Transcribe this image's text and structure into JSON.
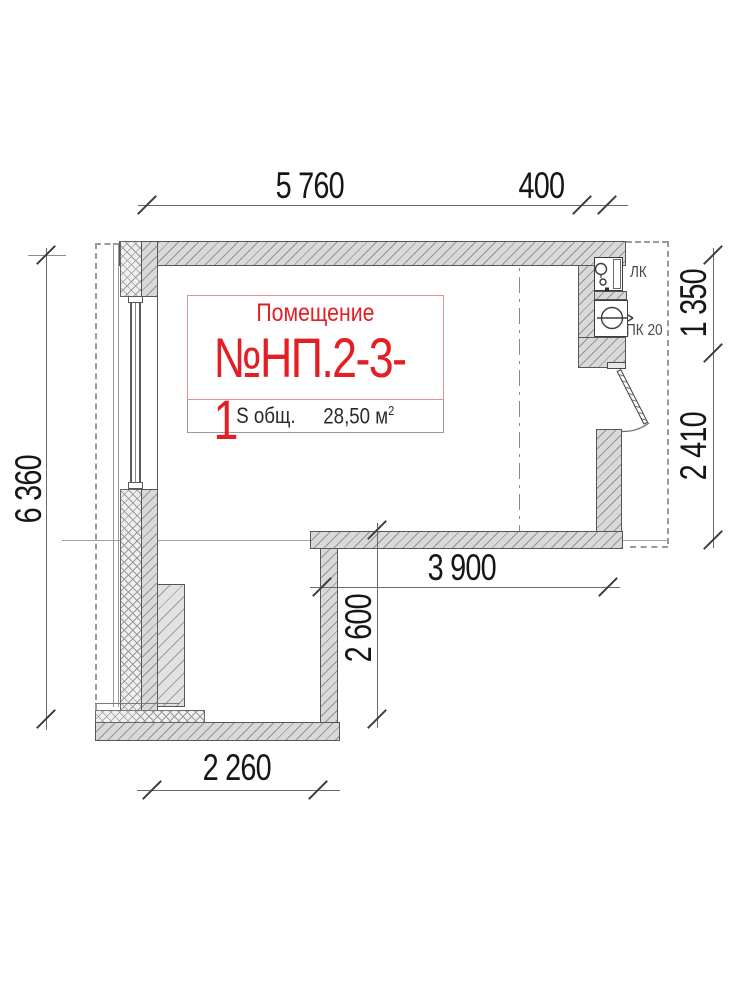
{
  "drawing": {
    "room_box": {
      "caption": "Помещение",
      "number": "№НП.2-3-1",
      "area_label": "S общ.",
      "area_value": "28,50 м",
      "area_sup": "2"
    },
    "dims": {
      "top_main": "5 760",
      "top_small": "400",
      "left": "6 360",
      "right_top": "1 350",
      "right_bottom": "2 410",
      "inner_h": "3 900",
      "inner_v": "2 600",
      "bottom": "2 260"
    },
    "labels": {
      "lk": "ЛК",
      "pk": "ПК 20"
    },
    "colors": {
      "accent_red": "#e31e24",
      "wall_fill": "#d9d9d9",
      "hatch_line": "#939393",
      "outline": "#565656",
      "dashed_boundary": "#9a9a9a"
    }
  }
}
